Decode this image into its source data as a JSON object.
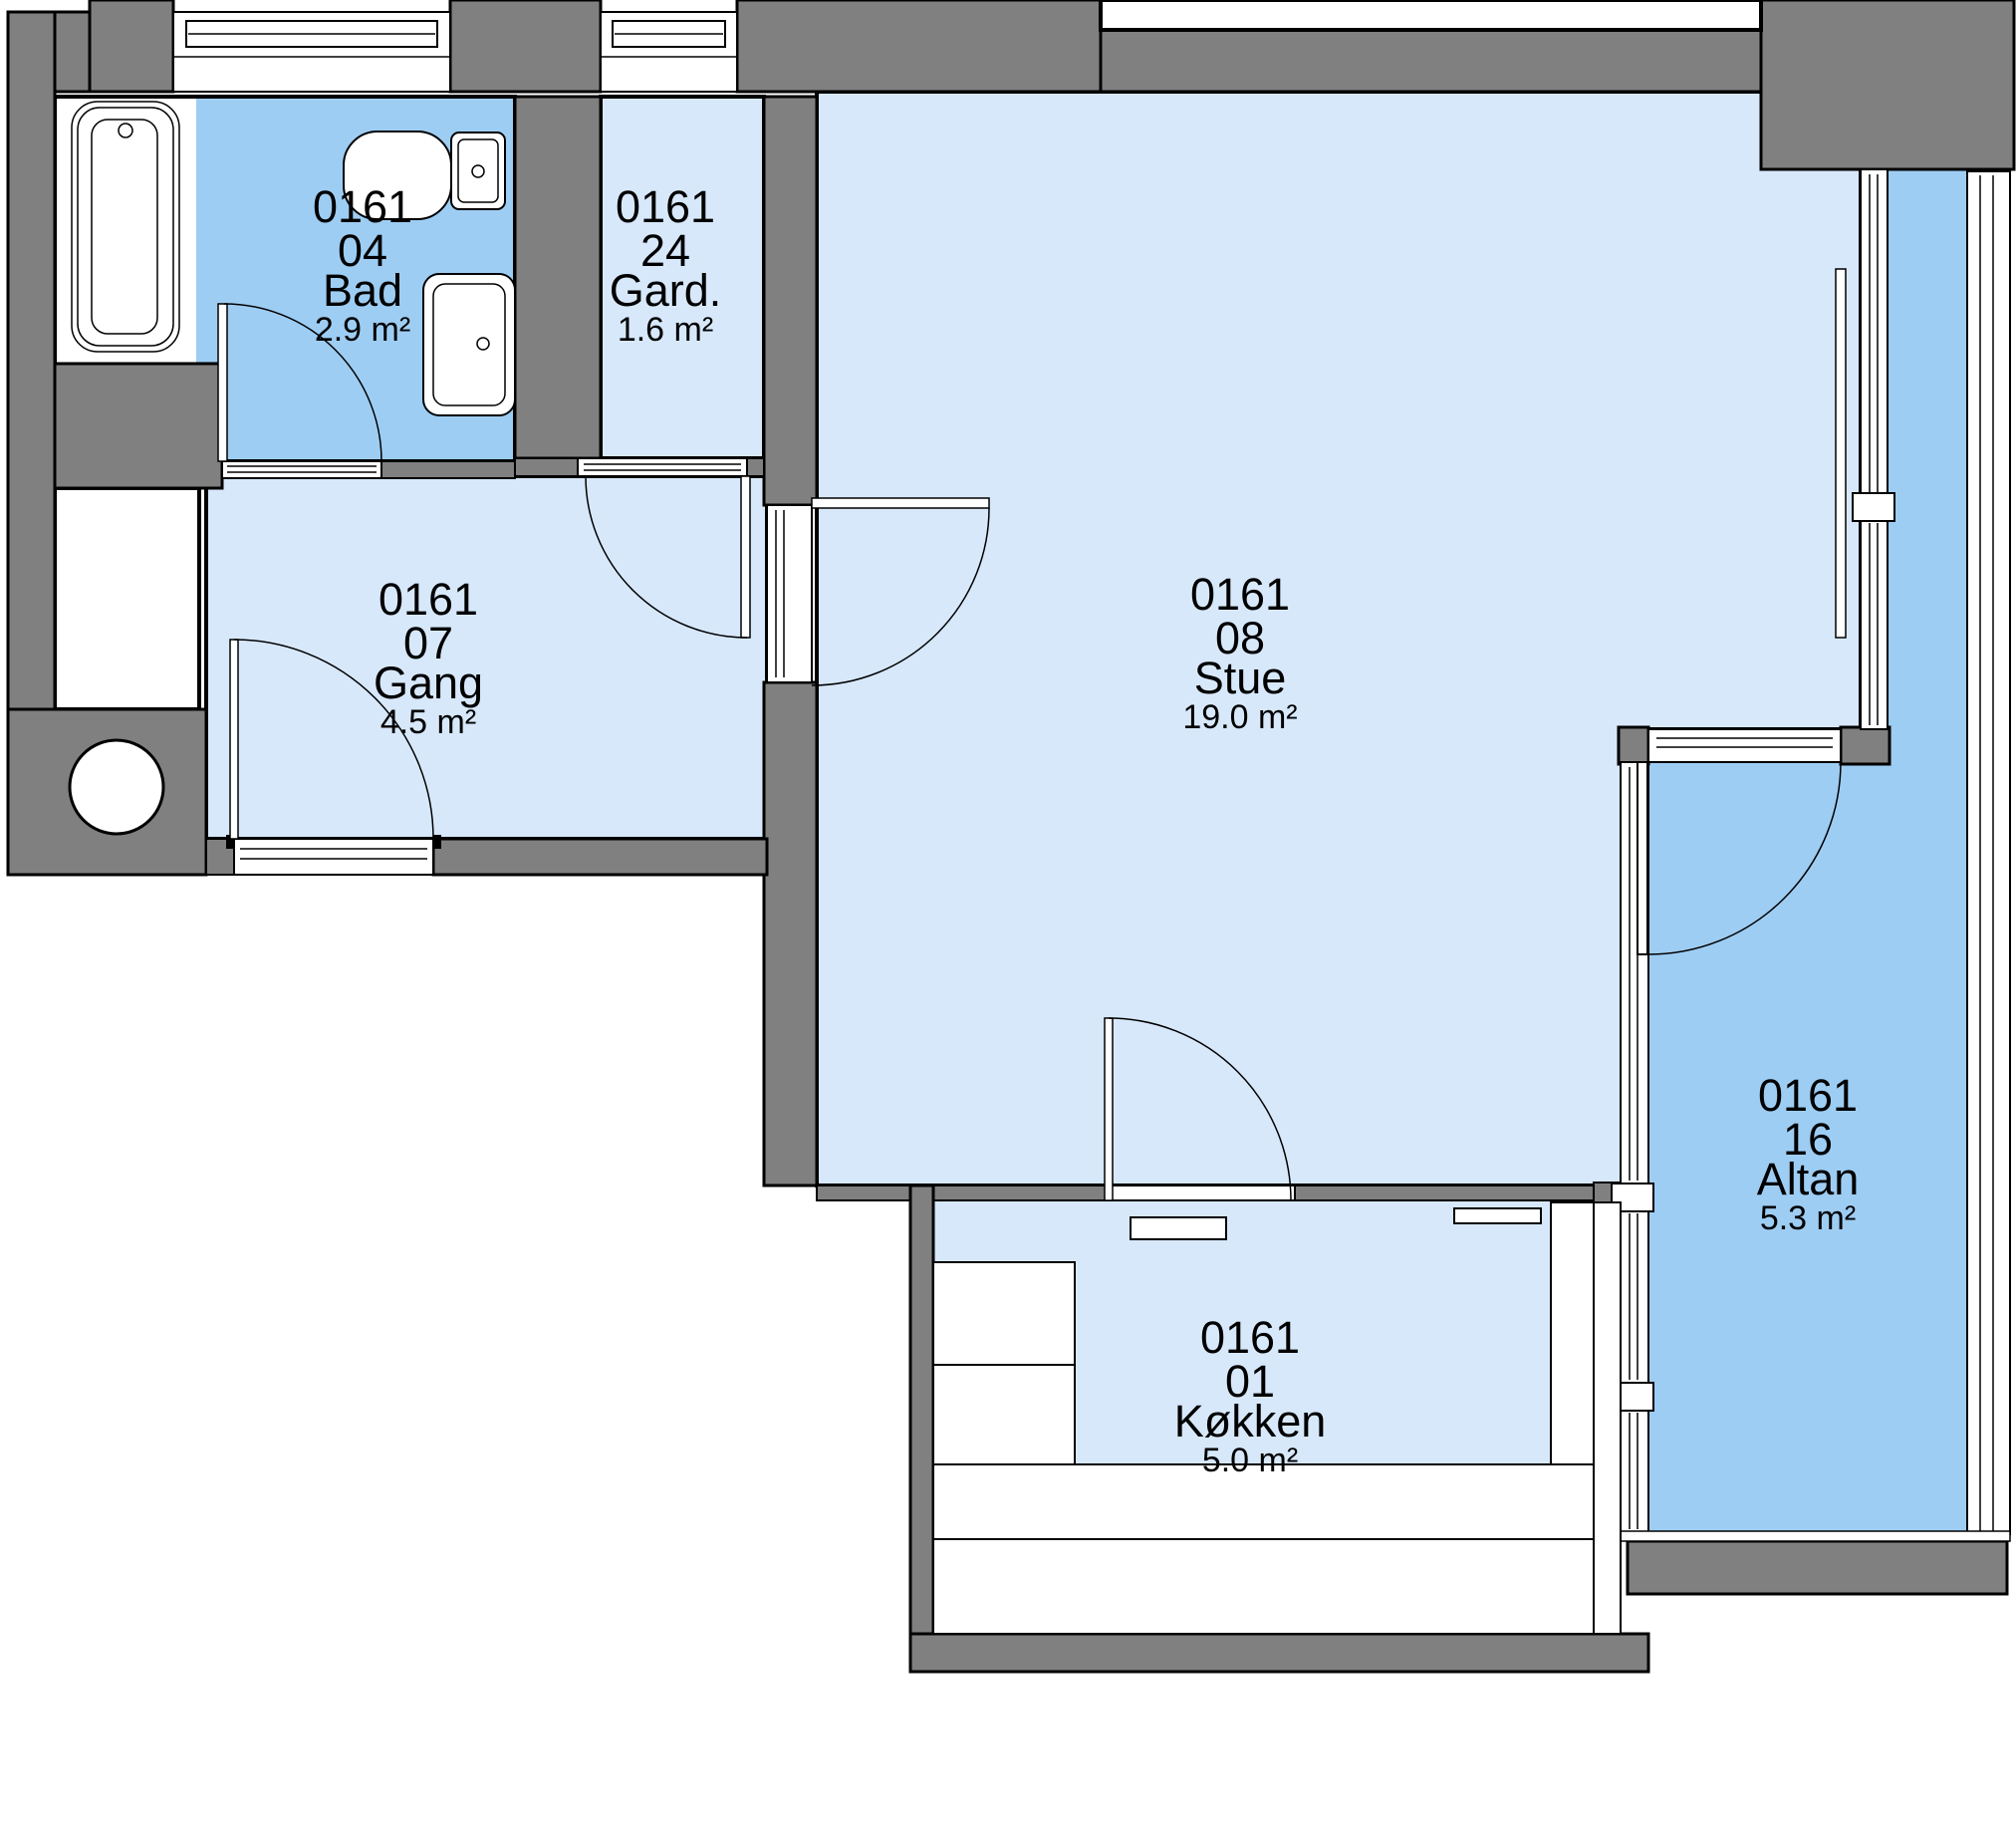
{
  "plan": {
    "colors": {
      "floor_light": "#D7E8FB",
      "floor_medium": "#9ECDF3",
      "wall_gray": "#808080",
      "line_black": "#000000"
    },
    "rooms": [
      {
        "id": "bad",
        "code": "0161",
        "number": "04",
        "name": "Bad",
        "area": "2.9 m²"
      },
      {
        "id": "gard",
        "code": "0161",
        "number": "24",
        "name": "Gard.",
        "area": "1.6 m²"
      },
      {
        "id": "gang",
        "code": "0161",
        "number": "07",
        "name": "Gang",
        "area": "4.5 m²"
      },
      {
        "id": "stue",
        "code": "0161",
        "number": "08",
        "name": "Stue",
        "area": "19.0 m²"
      },
      {
        "id": "koekken",
        "code": "0161",
        "number": "01",
        "name": "Køkken",
        "area": "5.0 m²"
      },
      {
        "id": "altan",
        "code": "0161",
        "number": "16",
        "name": "Altan",
        "area": "5.3 m²"
      }
    ]
  }
}
